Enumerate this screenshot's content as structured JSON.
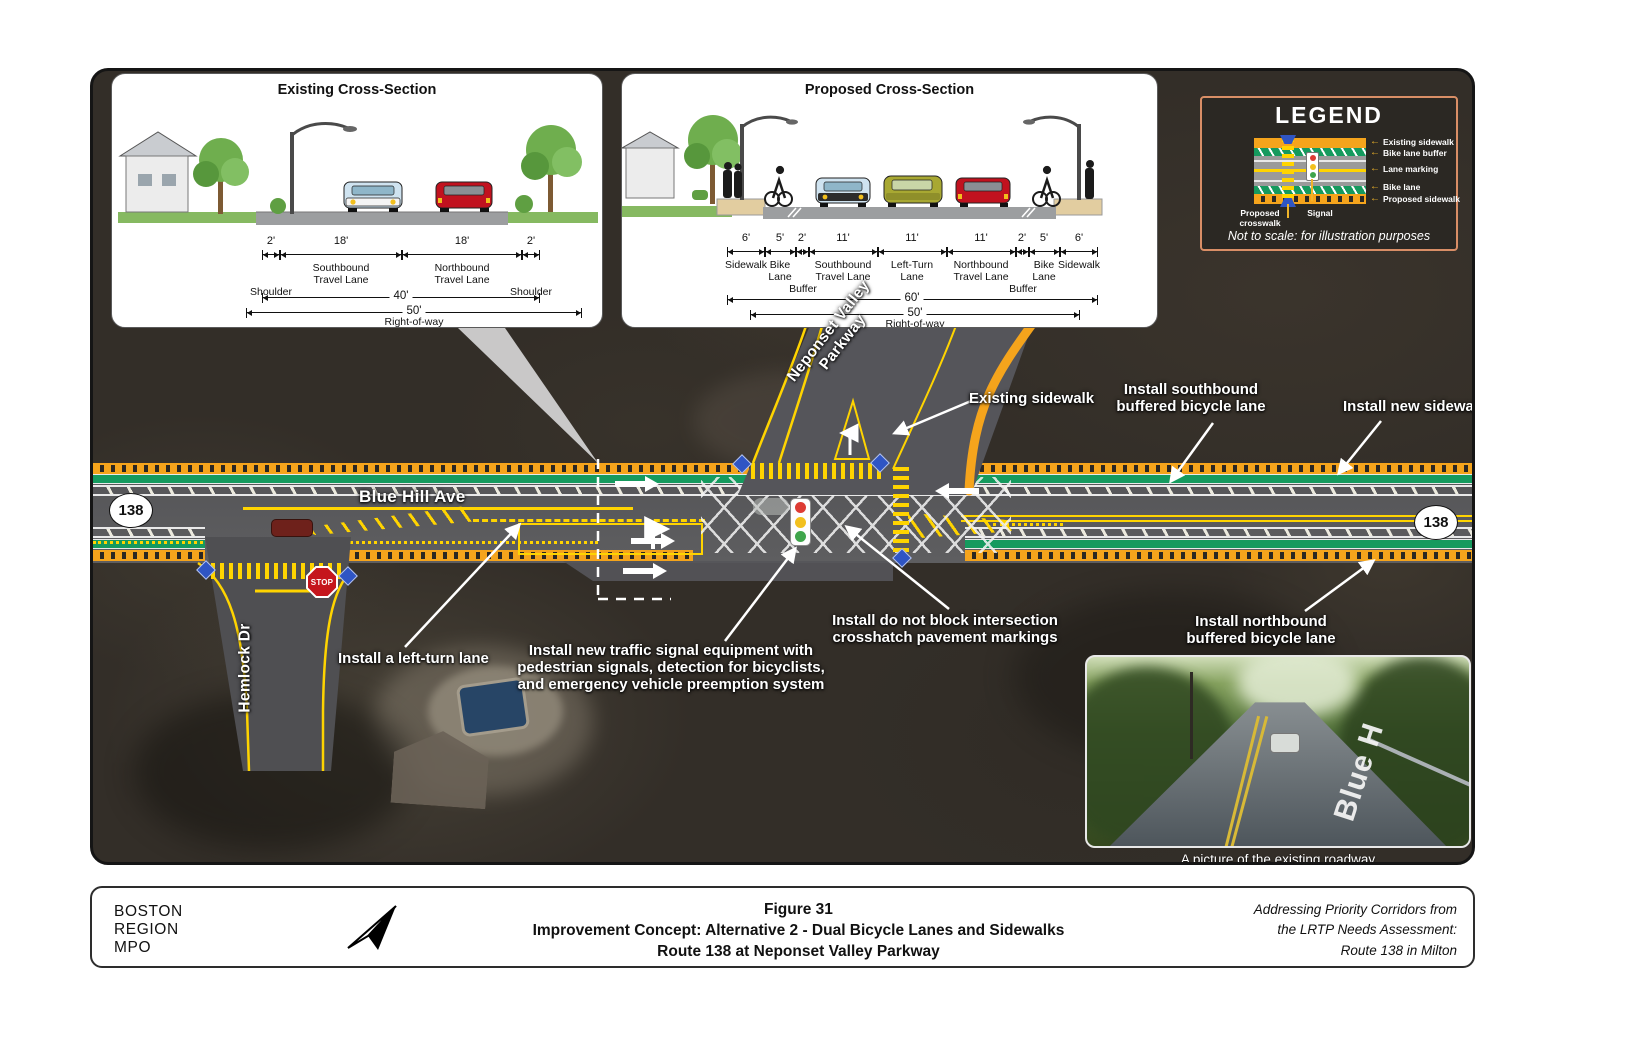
{
  "existing_section": {
    "title": "Existing Cross-Section",
    "dim_values": [
      "2'",
      "18'",
      "18'",
      "2'"
    ],
    "lane_names": [
      "Southbound\nTravel Lane",
      "Northbound\nTravel Lane"
    ],
    "shoulder": "Shoulder",
    "pavement_width": "40'",
    "row_width": "50'",
    "row_label": "Right-of-way"
  },
  "proposed_section": {
    "title": "Proposed Cross-Section",
    "dim_values": [
      "6'",
      "5'",
      "2'",
      "11'",
      "11'",
      "11'",
      "2'",
      "5'",
      "6'"
    ],
    "seg_names": [
      "Sidewalk",
      "Bike\nLane",
      "Southbound\nTravel Lane",
      "Left-Turn\nLane",
      "Northbound\nTravel Lane",
      "Bike\nLane",
      "Sidewalk"
    ],
    "buffer_label": "Buffer",
    "pavement_width": "60'",
    "row_width": "50'",
    "row_label": "Right-of-way"
  },
  "legend": {
    "title": "LEGEND",
    "items": [
      "Existing sidewalk",
      "Bike lane buffer",
      "Lane marking",
      "Bike lane",
      "Proposed sidewalk"
    ],
    "crosswalk_label": "Proposed\ncrosswalk",
    "signal_label": "Signal",
    "note": "Not to scale: for illustration purposes"
  },
  "map": {
    "route_shield": "138",
    "street": "Blue Hill Ave",
    "side_street": "Hemlock Dr",
    "parkway": "Neponset Valley\nParkway",
    "stop": "STOP",
    "photo_road_marking": "Blue H",
    "photo_caption": "A picture of the existing roadway",
    "callouts": {
      "existing_sidewalk": "Existing sidewalk",
      "southbound_bike": "Install southbound\nbuffered bicycle lane",
      "new_sidewalk": "Install new sidewalk",
      "northbound_bike": "Install northbound\nbuffered bicycle lane",
      "do_not_block": "Install do not block intersection\ncrosshatch pavement markings",
      "left_turn": "Install a left-turn lane",
      "signal_equipment": "Install new traffic signal equipment with\npedestrian signals, detection for bicyclists,\nand emergency vehicle preemption system"
    }
  },
  "footer": {
    "org_line1": "BOSTON",
    "org_line2": "REGION",
    "org_line3": "MPO",
    "figure": "Figure 31",
    "title_line1": "Improvement Concept: Alternative 2 - Dual Bicycle Lanes and Sidewalks",
    "title_line2": "Route 138 at Neponset Valley Parkway",
    "source": "Addressing Priority Corridors from\nthe LRTP Needs Assessment:\nRoute 138 in Milton"
  },
  "colors": {
    "bike_lane_green": "#159a5e",
    "buffer_orange": "#f5a41c",
    "marking_yellow": "#ffd400",
    "crosswalk_blue": "#2f55c4",
    "stop_red": "#c5161d"
  }
}
